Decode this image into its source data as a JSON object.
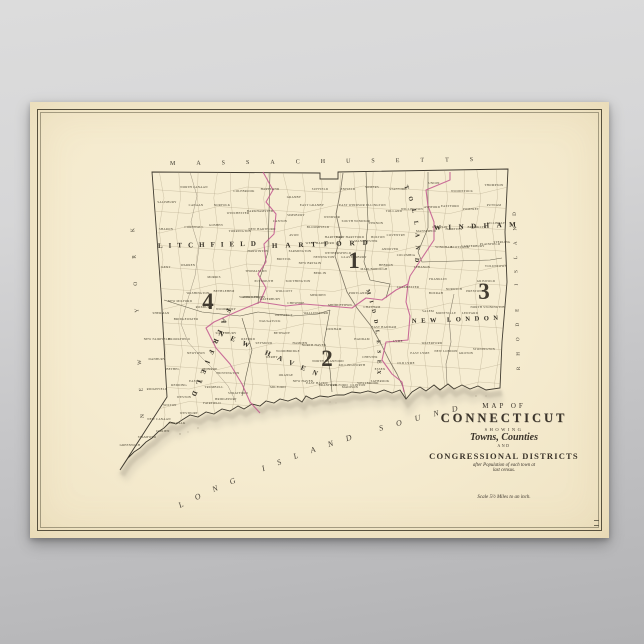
{
  "background": {
    "top_color": "#dcdcdc",
    "bottom_color": "#b2b2b4"
  },
  "poster": {
    "paper_color": "#f5ebcf",
    "frame_color": "#57503d",
    "district_line_color": "#c2568e",
    "title_block": {
      "map_of": "MAP OF",
      "state": "CONNECTICUT",
      "showing": "SHOWING",
      "towns_counties": "Towns, Counties",
      "and": "AND",
      "districts": "CONGRESSIONAL DISTRICTS",
      "note_line1": "after Population of each town at",
      "note_line2": "last census.",
      "scale": "Scale 5½ Miles to an inch."
    },
    "map": {
      "border_labels": [
        {
          "name": "massachusetts-label",
          "text": "MASSACHUSETTS",
          "path": "p-mass",
          "cls": "lbl-mass"
        },
        {
          "name": "new-york-label",
          "text": "NEW YORK",
          "path": "p-ny",
          "cls": "lbl-ny"
        },
        {
          "name": "rhode-island-label",
          "text": "RHODE ISLAND",
          "path": "p-ri",
          "cls": "lbl-ri"
        },
        {
          "name": "long-island-sound-label",
          "text": "LONG ISLAND SOUND",
          "path": "p-sound",
          "cls": "lbl-sound"
        }
      ],
      "county_labels": [
        {
          "name": "county-label-litchfield",
          "text": "LITCHFIELD",
          "path": "p-litchfield",
          "cls": "lbl-litchfield"
        },
        {
          "name": "county-label-hartford",
          "text": "HARTFORD",
          "path": "p-hartford",
          "cls": "lbl-hartford"
        },
        {
          "name": "county-label-windham",
          "text": "WINDHAM",
          "path": "p-windham",
          "cls": "lbl-windham"
        },
        {
          "name": "county-label-new-london",
          "text": "NEW LONDON",
          "path": "p-newlondon",
          "cls": "lbl-newlondon"
        },
        {
          "name": "county-label-tolland",
          "text": "TOLLAND",
          "path": "p-tolland",
          "cls": "lbl-tolland"
        },
        {
          "name": "county-label-middlesex",
          "text": "MIDDLESEX",
          "path": "p-middlesex",
          "cls": "lbl-middlesex"
        },
        {
          "name": "county-label-new-haven",
          "text": "NEW HAVEN",
          "path": "p-newhaven",
          "cls": "lbl-newhaven"
        },
        {
          "name": "county-label-fairfield",
          "text": "FAIRFIELD",
          "path": "p-fairfield",
          "cls": "lbl-fairfield"
        }
      ],
      "districts": [
        {
          "label": "1",
          "x": 324,
          "y": 166
        },
        {
          "label": "2",
          "x": 297,
          "y": 264
        },
        {
          "label": "3",
          "x": 454,
          "y": 197
        },
        {
          "label": "4",
          "x": 178,
          "y": 207
        }
      ],
      "towns": [
        {
          "n": "SALISBURY",
          "x": 137,
          "y": 101
        },
        {
          "n": "NORTH CANAAN",
          "x": 164,
          "y": 86
        },
        {
          "n": "CANAAN",
          "x": 166,
          "y": 104
        },
        {
          "n": "NORFOLK",
          "x": 192,
          "y": 104
        },
        {
          "n": "COLEBROOK",
          "x": 214,
          "y": 90
        },
        {
          "n": "HARTLAND",
          "x": 240,
          "y": 88
        },
        {
          "n": "WINCHESTER",
          "x": 208,
          "y": 112
        },
        {
          "n": "BARKHAMSTED",
          "x": 230,
          "y": 110
        },
        {
          "n": "NEW HARTFORD",
          "x": 232,
          "y": 128
        },
        {
          "n": "SHARON",
          "x": 136,
          "y": 128
        },
        {
          "n": "CORNWALL",
          "x": 164,
          "y": 126
        },
        {
          "n": "GOSHEN",
          "x": 186,
          "y": 124
        },
        {
          "n": "TORRINGTON",
          "x": 210,
          "y": 130
        },
        {
          "n": "KENT",
          "x": 136,
          "y": 166
        },
        {
          "n": "WARREN",
          "x": 158,
          "y": 164
        },
        {
          "n": "MORRIS",
          "x": 184,
          "y": 176
        },
        {
          "n": "HARWINTON",
          "x": 228,
          "y": 150
        },
        {
          "n": "THOMASTON",
          "x": 226,
          "y": 170
        },
        {
          "n": "PLYMOUTH",
          "x": 234,
          "y": 180
        },
        {
          "n": "WASHINGTON",
          "x": 168,
          "y": 192
        },
        {
          "n": "BETHLEHEM",
          "x": 194,
          "y": 190
        },
        {
          "n": "WATERTOWN",
          "x": 220,
          "y": 196
        },
        {
          "n": "NEW MILFORD",
          "x": 150,
          "y": 200
        },
        {
          "n": "ROXBURY",
          "x": 174,
          "y": 206
        },
        {
          "n": "WOODBURY",
          "x": 196,
          "y": 208
        },
        {
          "n": "BRIDGEWATER",
          "x": 156,
          "y": 218
        },
        {
          "n": "SOUTHBURY",
          "x": 196,
          "y": 232
        },
        {
          "n": "GRANBY",
          "x": 264,
          "y": 96
        },
        {
          "n": "EAST GRANBY",
          "x": 282,
          "y": 104
        },
        {
          "n": "SUFFIELD",
          "x": 290,
          "y": 88
        },
        {
          "n": "ENFIELD",
          "x": 318,
          "y": 88
        },
        {
          "n": "SIMSBURY",
          "x": 266,
          "y": 114
        },
        {
          "n": "WINDSOR",
          "x": 302,
          "y": 116
        },
        {
          "n": "EAST WINDSOR",
          "x": 322,
          "y": 104
        },
        {
          "n": "SOUTH WINDSOR",
          "x": 326,
          "y": 120
        },
        {
          "n": "BLOOMFIELD",
          "x": 288,
          "y": 126
        },
        {
          "n": "CANTON",
          "x": 250,
          "y": 120
        },
        {
          "n": "AVON",
          "x": 264,
          "y": 134
        },
        {
          "n": "HARTFORD",
          "x": 304,
          "y": 136
        },
        {
          "n": "WEST HARTFORD",
          "x": 290,
          "y": 142
        },
        {
          "n": "EAST HARTFORD",
          "x": 320,
          "y": 136
        },
        {
          "n": "MANCHESTER",
          "x": 336,
          "y": 140
        },
        {
          "n": "FARMINGTON",
          "x": 270,
          "y": 150
        },
        {
          "n": "NEWINGTON",
          "x": 294,
          "y": 156
        },
        {
          "n": "WETHERSFIELD",
          "x": 308,
          "y": 152
        },
        {
          "n": "GLASTONBURY",
          "x": 324,
          "y": 156
        },
        {
          "n": "BRISTOL",
          "x": 254,
          "y": 158
        },
        {
          "n": "NEW BRITAIN",
          "x": 280,
          "y": 162
        },
        {
          "n": "BERLIN",
          "x": 290,
          "y": 172
        },
        {
          "n": "SOUTHINGTON",
          "x": 268,
          "y": 180
        },
        {
          "n": "MARLBOROUGH",
          "x": 344,
          "y": 168
        },
        {
          "n": "SOMERS",
          "x": 342,
          "y": 86
        },
        {
          "n": "STAFFORD",
          "x": 368,
          "y": 88
        },
        {
          "n": "ELLINGTON",
          "x": 346,
          "y": 104
        },
        {
          "n": "TOLLAND",
          "x": 364,
          "y": 110
        },
        {
          "n": "VERNON",
          "x": 346,
          "y": 122
        },
        {
          "n": "WILLINGTON",
          "x": 382,
          "y": 108
        },
        {
          "n": "COVENTRY",
          "x": 366,
          "y": 134
        },
        {
          "n": "MANSFIELD",
          "x": 396,
          "y": 130
        },
        {
          "n": "BOLTON",
          "x": 348,
          "y": 136
        },
        {
          "n": "ANDOVER",
          "x": 360,
          "y": 148
        },
        {
          "n": "HEBRON",
          "x": 356,
          "y": 164
        },
        {
          "n": "COLUMBIA",
          "x": 376,
          "y": 154
        },
        {
          "n": "UNION",
          "x": 404,
          "y": 82
        },
        {
          "n": "WOODSTOCK",
          "x": 432,
          "y": 90
        },
        {
          "n": "THOMPSON",
          "x": 464,
          "y": 84
        },
        {
          "n": "ASHFORD",
          "x": 402,
          "y": 106
        },
        {
          "n": "EASTFORD",
          "x": 420,
          "y": 105
        },
        {
          "n": "PUTNAM",
          "x": 464,
          "y": 104
        },
        {
          "n": "POMFRET",
          "x": 441,
          "y": 108
        },
        {
          "n": "KILLINGLY",
          "x": 466,
          "y": 122
        },
        {
          "n": "BROOKLYN",
          "x": 447,
          "y": 126
        },
        {
          "n": "HAMPTON",
          "x": 424,
          "y": 128
        },
        {
          "n": "CHAPLIN",
          "x": 410,
          "y": 126
        },
        {
          "n": "WINDHAM",
          "x": 414,
          "y": 146
        },
        {
          "n": "SCOTLAND",
          "x": 430,
          "y": 146
        },
        {
          "n": "CANTERBURY",
          "x": 443,
          "y": 145
        },
        {
          "n": "PLAINFIELD",
          "x": 460,
          "y": 143
        },
        {
          "n": "STERLING",
          "x": 472,
          "y": 141
        },
        {
          "n": "VOLUNTOWN",
          "x": 466,
          "y": 165
        },
        {
          "n": "LEBANON",
          "x": 392,
          "y": 166
        },
        {
          "n": "FRANKLIN",
          "x": 408,
          "y": 178
        },
        {
          "n": "NORWICH",
          "x": 424,
          "y": 188
        },
        {
          "n": "PRESTON",
          "x": 444,
          "y": 190
        },
        {
          "n": "GRISWOLD",
          "x": 456,
          "y": 180
        },
        {
          "n": "BOZRAH",
          "x": 406,
          "y": 192
        },
        {
          "n": "COLCHESTER",
          "x": 378,
          "y": 186
        },
        {
          "n": "SALEM",
          "x": 398,
          "y": 210
        },
        {
          "n": "MONTVILLE",
          "x": 416,
          "y": 212
        },
        {
          "n": "LEDYARD",
          "x": 440,
          "y": 212
        },
        {
          "n": "NORTH STONINGTON",
          "x": 458,
          "y": 206
        },
        {
          "n": "STONINGTON",
          "x": 454,
          "y": 248
        },
        {
          "n": "GROTON",
          "x": 436,
          "y": 252
        },
        {
          "n": "NEW LONDON",
          "x": 416,
          "y": 250
        },
        {
          "n": "WATERFORD",
          "x": 402,
          "y": 242
        },
        {
          "n": "EAST LYME",
          "x": 390,
          "y": 252
        },
        {
          "n": "OLD LYME",
          "x": 376,
          "y": 262
        },
        {
          "n": "LYME",
          "x": 368,
          "y": 240
        },
        {
          "n": "EAST HADDAM",
          "x": 354,
          "y": 226
        },
        {
          "n": "HADDAM",
          "x": 332,
          "y": 238
        },
        {
          "n": "CHATHAM",
          "x": 342,
          "y": 206
        },
        {
          "n": "PORTLAND",
          "x": 328,
          "y": 192
        },
        {
          "n": "MIDDLETOWN",
          "x": 310,
          "y": 204
        },
        {
          "n": "DURHAM",
          "x": 304,
          "y": 228
        },
        {
          "n": "KILLINGWORTH",
          "x": 322,
          "y": 264
        },
        {
          "n": "CHESTER",
          "x": 340,
          "y": 256
        },
        {
          "n": "ESSEX",
          "x": 350,
          "y": 268
        },
        {
          "n": "SAYBROOK",
          "x": 350,
          "y": 280
        },
        {
          "n": "WESTBROOK",
          "x": 338,
          "y": 282
        },
        {
          "n": "CLINTON",
          "x": 328,
          "y": 284
        },
        {
          "n": "MERIDEN",
          "x": 288,
          "y": 194
        },
        {
          "n": "WALLINGFORD",
          "x": 286,
          "y": 212
        },
        {
          "n": "CHESHIRE",
          "x": 266,
          "y": 202
        },
        {
          "n": "WATERBURY",
          "x": 240,
          "y": 198
        },
        {
          "n": "WOLCOTT",
          "x": 254,
          "y": 190
        },
        {
          "n": "MIDDLEBURY",
          "x": 224,
          "y": 196
        },
        {
          "n": "NAUGATUCK",
          "x": 240,
          "y": 220
        },
        {
          "n": "PROSPECT",
          "x": 254,
          "y": 214
        },
        {
          "n": "BETHANY",
          "x": 252,
          "y": 232
        },
        {
          "n": "HAMDEN",
          "x": 270,
          "y": 242
        },
        {
          "n": "NORTH HAVEN",
          "x": 284,
          "y": 244
        },
        {
          "n": "NORTH BRANFORD",
          "x": 298,
          "y": 260
        },
        {
          "n": "WOODBRIDGE",
          "x": 258,
          "y": 250
        },
        {
          "n": "NEW HAVEN",
          "x": 273,
          "y": 280
        },
        {
          "n": "EAST HAVEN",
          "x": 287,
          "y": 282
        },
        {
          "n": "BRANFORD",
          "x": 298,
          "y": 284
        },
        {
          "n": "GUILFORD",
          "x": 309,
          "y": 284
        },
        {
          "n": "MADISON",
          "x": 320,
          "y": 286
        },
        {
          "n": "DERBY",
          "x": 242,
          "y": 256
        },
        {
          "n": "SEYMOUR",
          "x": 234,
          "y": 242
        },
        {
          "n": "OXFORD",
          "x": 218,
          "y": 238
        },
        {
          "n": "MILFORD",
          "x": 248,
          "y": 286
        },
        {
          "n": "ORANGE",
          "x": 256,
          "y": 274
        },
        {
          "n": "SHERMAN",
          "x": 131,
          "y": 212
        },
        {
          "n": "NEW FAIRFIELD",
          "x": 127,
          "y": 238
        },
        {
          "n": "DANBURY",
          "x": 127,
          "y": 258
        },
        {
          "n": "BROOKFIELD",
          "x": 149,
          "y": 238
        },
        {
          "n": "NEWTOWN",
          "x": 166,
          "y": 252
        },
        {
          "n": "BETHEL",
          "x": 143,
          "y": 268
        },
        {
          "n": "REDDING",
          "x": 149,
          "y": 284
        },
        {
          "n": "RIDGEFIELD",
          "x": 127,
          "y": 288
        },
        {
          "n": "EASTON",
          "x": 166,
          "y": 280
        },
        {
          "n": "MONROE",
          "x": 180,
          "y": 268
        },
        {
          "n": "TRUMBULL",
          "x": 184,
          "y": 286
        },
        {
          "n": "HUNTINGTON",
          "x": 198,
          "y": 272
        },
        {
          "n": "WESTON",
          "x": 154,
          "y": 296
        },
        {
          "n": "WILTON",
          "x": 140,
          "y": 304
        },
        {
          "n": "WESTPORT",
          "x": 159,
          "y": 312
        },
        {
          "n": "FAIRFIELD",
          "x": 182,
          "y": 302
        },
        {
          "n": "BRIDGEPORT",
          "x": 196,
          "y": 298
        },
        {
          "n": "STRATFORD",
          "x": 208,
          "y": 292
        },
        {
          "n": "NEW CANAAN",
          "x": 129,
          "y": 318
        },
        {
          "n": "NORWALK",
          "x": 147,
          "y": 322
        },
        {
          "n": "DARIEN",
          "x": 133,
          "y": 330
        },
        {
          "n": "STAMFORD",
          "x": 117,
          "y": 336
        },
        {
          "n": "GREENWICH",
          "x": 100,
          "y": 344
        }
      ]
    }
  }
}
